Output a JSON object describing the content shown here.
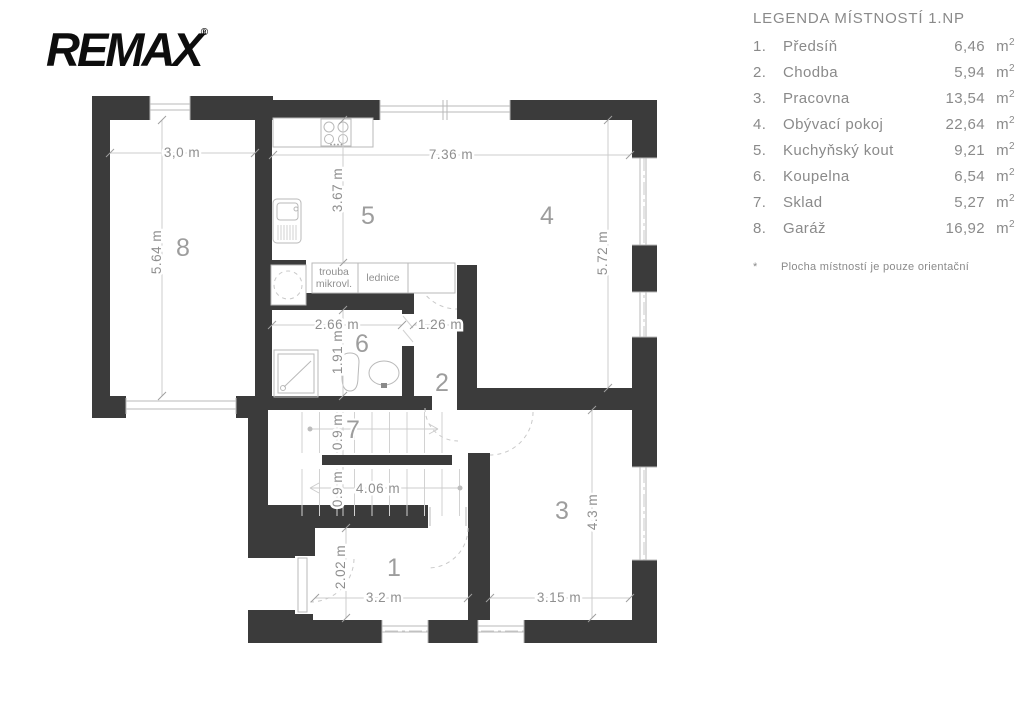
{
  "logo": {
    "brand": "REMAX",
    "reg": "®"
  },
  "legend": {
    "title": "LEGENDA MÍSTNOSTÍ 1.NP",
    "rows": [
      {
        "num": "1.",
        "name": "Předsíň",
        "area": "6,46",
        "unit": "m",
        "sup": "2"
      },
      {
        "num": "2.",
        "name": "Chodba",
        "area": "5,94",
        "unit": "m",
        "sup": "2"
      },
      {
        "num": "3.",
        "name": "Pracovna",
        "area": "13,54",
        "unit": "m",
        "sup": "2"
      },
      {
        "num": "4.",
        "name": "Obývací pokoj",
        "area": "22,64",
        "unit": "m",
        "sup": "2"
      },
      {
        "num": "5.",
        "name": "Kuchyňský kout",
        "area": "9,21",
        "unit": "m",
        "sup": "2"
      },
      {
        "num": "6.",
        "name": "Koupelna",
        "area": "6,54",
        "unit": "m",
        "sup": "2"
      },
      {
        "num": "7.",
        "name": "Sklad",
        "area": "5,27",
        "unit": "m",
        "sup": "2"
      },
      {
        "num": "8.",
        "name": "Garáž",
        "area": "16,92",
        "unit": "m",
        "sup": "2"
      }
    ],
    "footnote_mark": "*",
    "footnote": "Plocha místností je pouze orientační"
  },
  "plan": {
    "rooms": {
      "r1": "1",
      "r2": "2",
      "r3": "3",
      "r4": "4",
      "r5": "5",
      "r6": "6",
      "r7": "7",
      "r8": "8"
    },
    "dims": {
      "garage_w": "3,0 m",
      "garage_h": "5.64 m",
      "kitchen_h": "3.67 m",
      "living_w": "7.36 m",
      "living_h": "5.72 m",
      "bath_w": "2.66 m",
      "hall_w": "1.26 m",
      "bath_h": "1.91 m",
      "stair_w_top": "0.9 m",
      "stair_w_bottom": "0.9 m",
      "stair_len": "4.06 m",
      "entry_h": "2.02 m",
      "entry_w": "3.2 m",
      "study_w": "3.15 m",
      "study_h": "4.3 m"
    },
    "labels": {
      "oven1": "trouba",
      "oven2": "mikrovl.",
      "fridge": "lednice"
    }
  },
  "colors": {
    "wall": "#3b3b3b",
    "line": "#c9c9c9",
    "dim_text": "#8f8f8f",
    "room_number": "#9d9d9d",
    "legend_text": "#8a8a8a",
    "logo": "#0d0d0d",
    "background": "#ffffff"
  }
}
